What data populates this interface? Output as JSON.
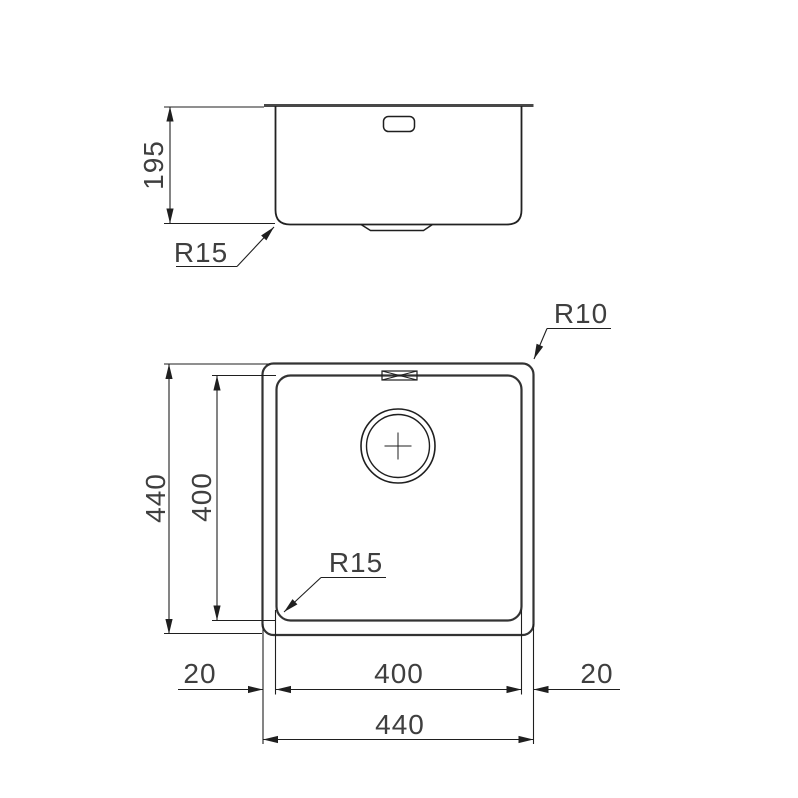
{
  "views": {
    "side_view": {
      "height_dimension": "195",
      "corner_radius_label": "R15"
    },
    "plan_view": {
      "outer_corner_radius_label": "R10",
      "inner_corner_radius_label": "R15",
      "outer_height_dimension": "440",
      "inner_height_dimension": "400",
      "left_rim_dimension": "20",
      "inner_width_dimension": "400",
      "right_rim_dimension": "20",
      "outer_width_dimension": "440"
    }
  },
  "colors": {
    "background": "#ffffff",
    "outline": "#333333",
    "dimension_line": "#1f1f1f",
    "text": "#3f3f3f"
  }
}
